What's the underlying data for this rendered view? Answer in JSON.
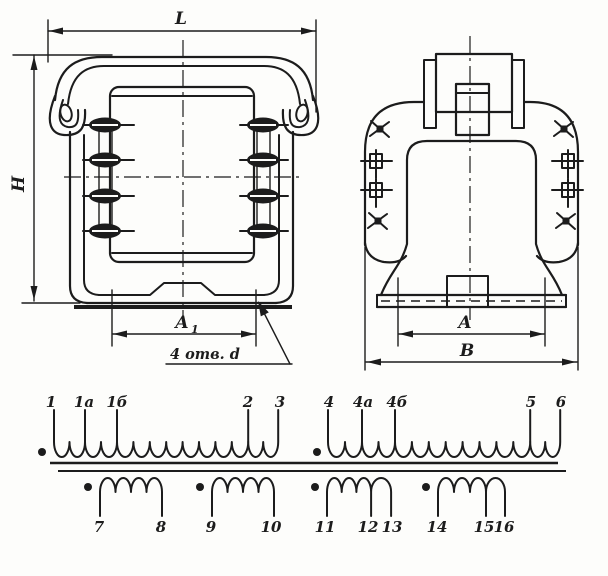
{
  "colors": {
    "ink": "#1c1c1c",
    "paper": "#fdfdfb"
  },
  "views": {
    "front": {
      "dim_length": "L",
      "dim_height": "H",
      "dim_mount_spacing_main": "A",
      "dim_mount_spacing_sub": "1",
      "holes_note": "4 отв. d"
    },
    "side": {
      "dim_mount_spacing": "A",
      "dim_width": "B"
    }
  },
  "schematic": {
    "primary_1": {
      "terminals": [
        "1",
        "1а",
        "1б",
        "2",
        "3"
      ]
    },
    "primary_2": {
      "terminals": [
        "4",
        "4а",
        "4б",
        "5",
        "6"
      ]
    },
    "secondary_1": {
      "terminals": [
        "7",
        "8"
      ]
    },
    "secondary_2": {
      "terminals": [
        "9",
        "10"
      ]
    },
    "secondary_3": {
      "terminals": [
        "11",
        "12",
        "13"
      ]
    },
    "secondary_4": {
      "terminals": [
        "14",
        "15",
        "16"
      ]
    }
  }
}
